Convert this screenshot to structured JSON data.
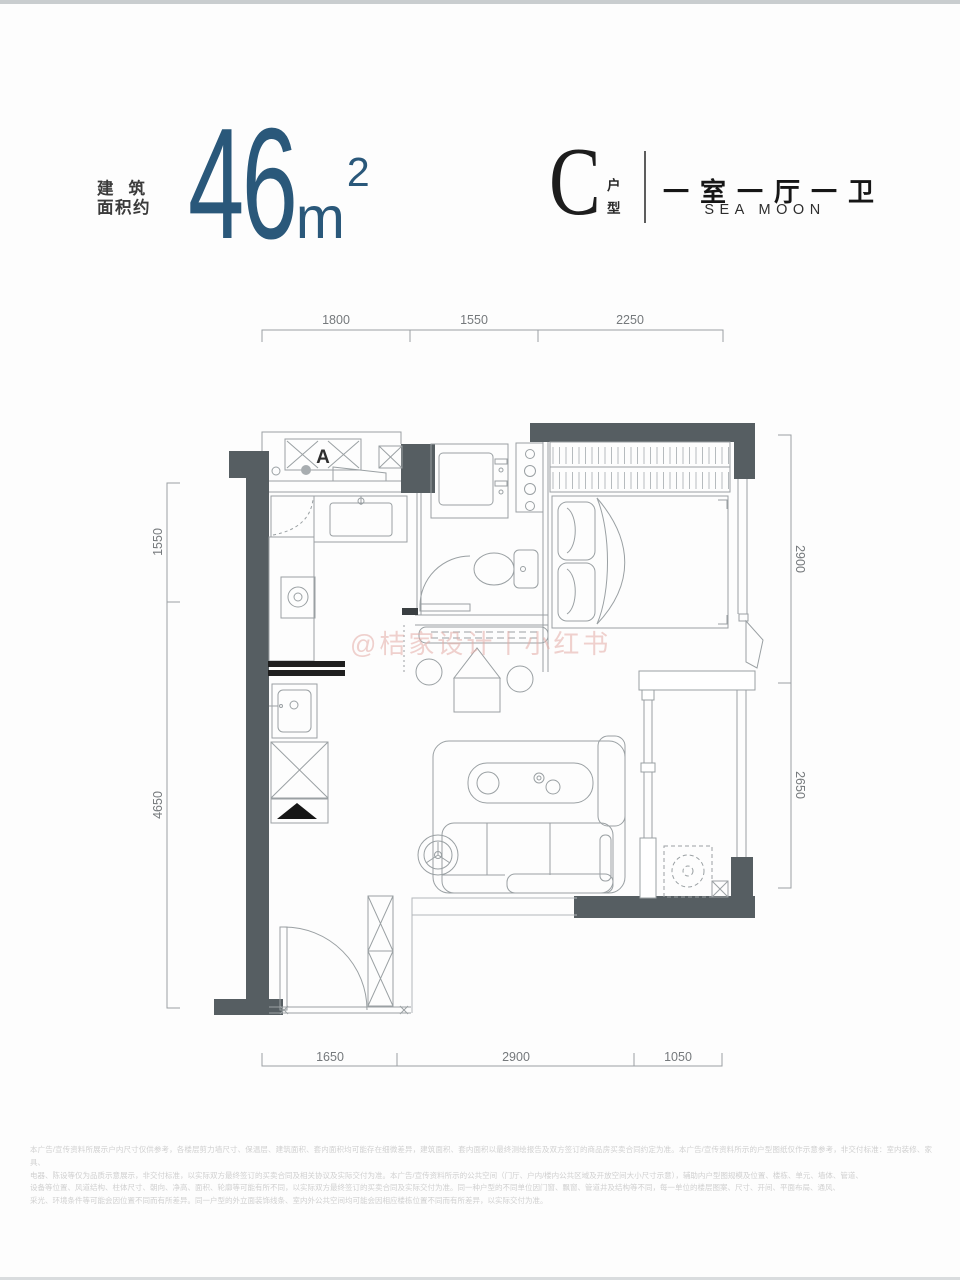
{
  "header": {
    "area_label_line1": "建筑",
    "area_label_line2": "面积约",
    "area_value": "46",
    "area_unit": "m",
    "area_exponent": "2",
    "unit_letter": "C",
    "unit_type_char1": "户",
    "unit_type_char2": "型",
    "layout": "一室一厅一卫",
    "brand": "SEA MOON",
    "accent_color": "#2a587a"
  },
  "plan": {
    "label_a": "A",
    "watermark": "@桔家设计丨小红书",
    "wall_color": "#565e62",
    "line_color": "#9aa0a3",
    "dims": {
      "top": [
        "1800",
        "1550",
        "2250"
      ],
      "bottom": [
        "1650",
        "2900",
        "1050"
      ],
      "left": [
        "1550",
        "4650"
      ],
      "right": [
        "2900",
        "2650"
      ]
    }
  },
  "footer": {
    "lines": [
      "本广告/宣传资料所展示户内尺寸仅供参考，各楼层剪力墙尺寸、保温层、建筑面积、套内面积均可能存在细微差异，建筑面积、套内面积以最终测绘报告及双方签订的商品房买卖合同约定为准。本广告/宣传资料所示的户型图纸仅作示意参考，非交付标准：室内装修、家具、",
      "电器、陈设等仅为品质示意展示，非交付标准，以实际双方最终签订的买卖合同及相关协议及实际交付为准。本广告/宣传资料所示的公共空间（门厅、户内/楼内公共区域及开放空间大小尺寸示意），辅助内户型图规模及位置、楼栋、单元、墙体、管道、",
      "设备等位置、风道结构、柱体尺寸、朝向、净高、面积、轮廓等可能有所不同，以实际双方最终签订的买卖合同及实际交付为准。同一种户型的不同单位因门窗、飘窗、管道井及结构等不同，每一单位的楼层图案、尺寸、开间、平面布局、通风、",
      "采光、环境条件等可能会因位置不同而有所差异。同一户型的外立面装饰线条、室内外公共空间均可能会因相应楼栋位置不同而有所差异，以实际交付为准。"
    ]
  }
}
